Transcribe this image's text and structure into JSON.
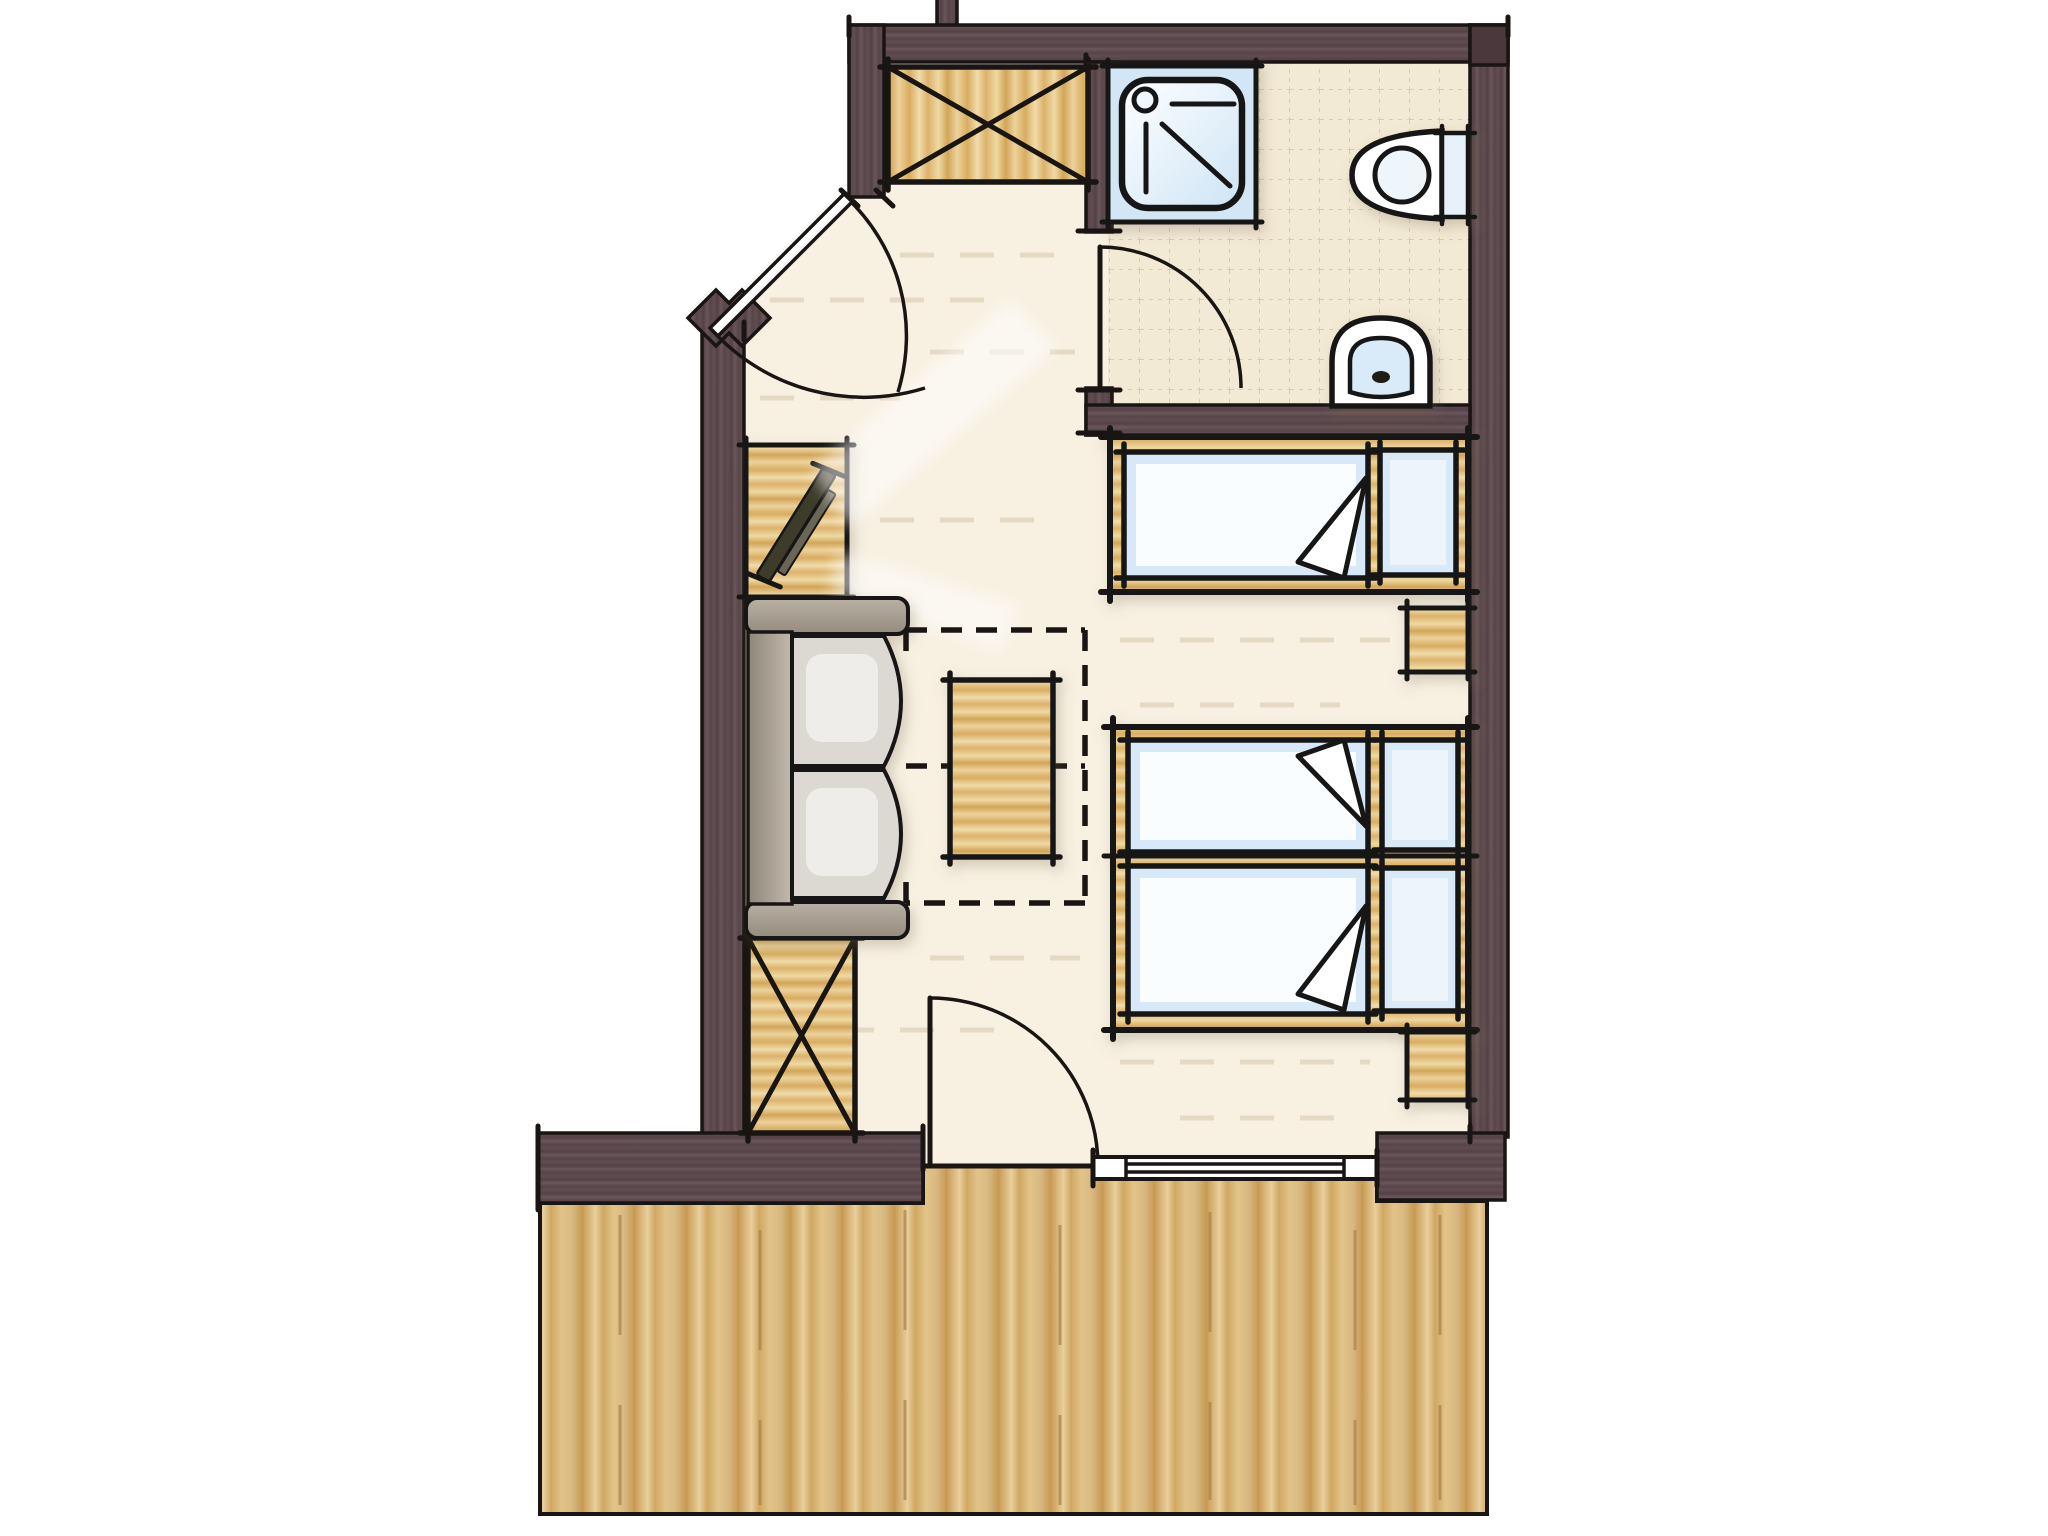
{
  "title": "Hand-drawn hotel room floor plan with bathroom, wardrobes, sofa corner, three beds and wooden terrace",
  "canvas": {
    "width": 2048,
    "height": 1536,
    "background": "#ffffff"
  },
  "palette": {
    "line": "#181512",
    "wall": "#5c494e",
    "wall-dark": "#4a383d",
    "floor": "#f8f1e2",
    "floor-streak": "#d9cab0",
    "tile": "#f3ead6",
    "tile-line": "#d9c3a0",
    "wood": "#e3c07e",
    "deck": "#d9ba82",
    "shower-bg": "#d2e6f5",
    "fixture-white": "#ffffff",
    "fixture-blue": "#d9eaf8",
    "mattress": "#d7e9f8",
    "mattress-core": "#fcfeff",
    "pillow": "#d8e9f7",
    "sofa-grey": "#aba294",
    "cushion": "#dcd9d3",
    "tv-dark": "#3e3a2c"
  },
  "rooms": [
    {
      "id": "entry",
      "label": "Entry hall",
      "floor": "cream screed",
      "features": [
        "entrance door in angled wall",
        "built-in wardrobe"
      ]
    },
    {
      "id": "bathroom",
      "label": "Bathroom",
      "floor": "beige tile grid",
      "fixtures": [
        "shower",
        "toilet",
        "bidet"
      ],
      "door": "swings into bathroom"
    },
    {
      "id": "bedroom",
      "label": "Bed / living room",
      "floor": "cream screed",
      "furniture": [
        "tv sideboard",
        "two-seat sofa",
        "fold-out bed zone (dashed)",
        "coffee table",
        "wardrobe",
        "single bed",
        "double bed with two mattresses",
        "two nightstands"
      ]
    },
    {
      "id": "terrace",
      "label": "Wooden terrace",
      "floor": "vertical plank deck",
      "access": [
        "balcony door",
        "sliding window"
      ]
    }
  ],
  "furniture": [
    {
      "id": "wardrobe-entry",
      "label": "Wardrobe with X symbol",
      "room": "entry"
    },
    {
      "id": "shower",
      "label": "Shower tray with head symbol",
      "room": "bathroom"
    },
    {
      "id": "toilet",
      "label": "Toilet with cistern on right wall",
      "room": "bathroom"
    },
    {
      "id": "bidet",
      "label": "Bidet on bottom wall",
      "room": "bathroom"
    },
    {
      "id": "tv-sideboard",
      "label": "Sideboard with flat TV",
      "room": "bedroom"
    },
    {
      "id": "sofa",
      "label": "Two-cushion sofa against left wall",
      "room": "bedroom"
    },
    {
      "id": "sofa-bed-zone",
      "label": "Dashed fold-out bed outline",
      "room": "bedroom"
    },
    {
      "id": "coffee-table",
      "label": "Wooden table",
      "room": "bedroom"
    },
    {
      "id": "wardrobe-living",
      "label": "Wardrobe with X symbol",
      "room": "bedroom"
    },
    {
      "id": "single-bed",
      "label": "Single bed, pillow at right",
      "room": "bedroom"
    },
    {
      "id": "double-bed",
      "label": "Double bed, two mattresses, pillows at right",
      "room": "bedroom"
    },
    {
      "id": "nightstand-1",
      "label": "Nightstand between beds",
      "room": "bedroom"
    },
    {
      "id": "nightstand-2",
      "label": "Nightstand below double bed",
      "room": "bedroom"
    }
  ],
  "openings": [
    {
      "id": "entrance-door",
      "label": "Entrance door in 45° wall with double swing arcs"
    },
    {
      "id": "bathroom-door",
      "label": "Bathroom door, opens inward"
    },
    {
      "id": "balcony-door",
      "label": "Terrace door, opens into room"
    },
    {
      "id": "sliding-window",
      "label": "Sliding glass door to terrace"
    }
  ]
}
